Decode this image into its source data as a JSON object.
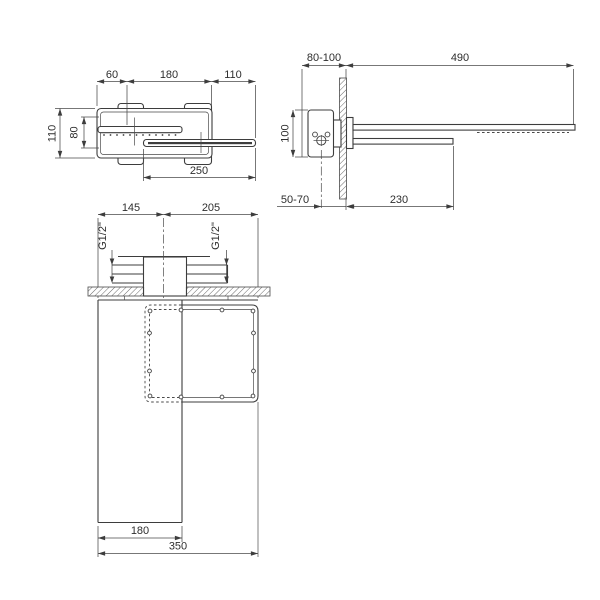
{
  "drawing": {
    "type": "technical-dimension-drawing",
    "subject": "wall-mounted waterfall shower head and spout, three orthographic views",
    "background_color": "#ffffff",
    "line_color": "#3d3d3d"
  },
  "labels": {
    "top_view": {
      "width_60": "60",
      "depth_180": "180",
      "width_110": "110",
      "height_110": "110",
      "height_80": "80",
      "length_250": "250"
    },
    "side_view": {
      "range_80_100": "80-100",
      "length_490": "490",
      "height_100": "100",
      "range_50_70": "50-70",
      "length_230": "230"
    },
    "front_view": {
      "offset_145": "145",
      "offset_205": "205",
      "thread_left": "G1/2\"",
      "thread_right": "G1/2\"",
      "width_180": "180",
      "width_350": "350"
    }
  }
}
